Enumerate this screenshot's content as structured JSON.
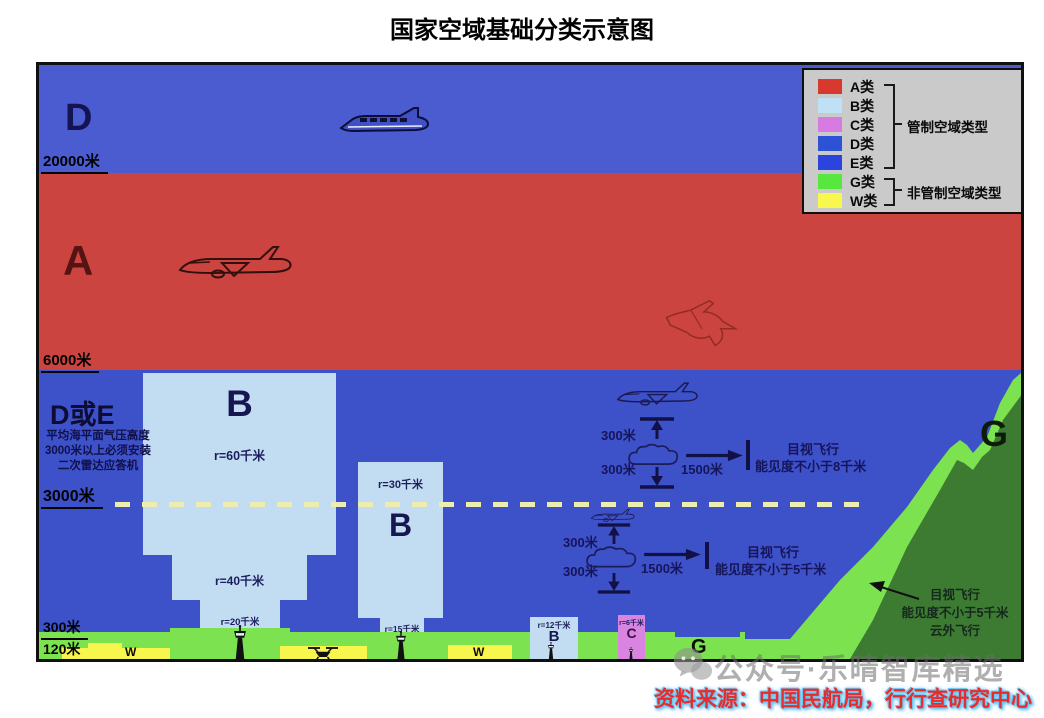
{
  "title": "国家空域基础分类示意图",
  "source": "资料来源：中国民航局，行行查研究中心",
  "watermark": "公众号·乐晴智库精选",
  "legend": {
    "items": [
      {
        "label": "A类",
        "color": "#d8392f"
      },
      {
        "label": "B类",
        "color": "#c0e0f6"
      },
      {
        "label": "C类",
        "color": "#d77ae2"
      },
      {
        "label": "D类",
        "color": "#2e52d6"
      },
      {
        "label": "E类",
        "color": "#2b44de"
      },
      {
        "label": "G类",
        "color": "#57e73f"
      },
      {
        "label": "W类",
        "color": "#f7f74e"
      }
    ],
    "groups": [
      {
        "label": "管制空域类型"
      },
      {
        "label": "非管制空域类型"
      }
    ]
  },
  "altitudes": {
    "a20000": "20000米",
    "a6000": "6000米",
    "a3000": "3000米",
    "a300": "300米",
    "a120": "120米"
  },
  "zones": {
    "d_upper": "D",
    "a": "A",
    "d_or_e": "D或E",
    "b_large": "B",
    "b_medium": "B",
    "b_small": "B",
    "c": "C",
    "g_mountain": "G",
    "g_ground": "G",
    "w_left": "W",
    "w_mid": "W"
  },
  "radius_labels": {
    "b_large_top": "r=60千米",
    "b_large_mid": "r=40千米",
    "b_large_base": "r=20千米",
    "b_medium_top": "r=30千米",
    "b_medium_base": "r=15千米",
    "b_small": "r=12千米",
    "c": "r=6千米"
  },
  "notes": {
    "transponder_line1": "平均海平面气压高度",
    "transponder_line2": "3000米以上必须安装",
    "transponder_line3": "二次雷达应答机"
  },
  "vfr_upper": {
    "gap_above": "300米",
    "gap_below": "300米",
    "visibility_dist": "1500米",
    "line1": "目视飞行",
    "line2": "能见度不小于8千米"
  },
  "vfr_lower": {
    "gap_above": "300米",
    "gap_below": "300米",
    "visibility_dist": "1500米",
    "line1": "目视飞行",
    "line2": "能见度不小于5千米"
  },
  "vfr_mountain": {
    "line1": "目视飞行",
    "line2": "能见度不小于5千米",
    "line3": "云外飞行"
  },
  "colors": {
    "zone_d_blue": "#4a5ccf",
    "zone_a_red": "#cc4440",
    "zone_lower_blue": "#3d51c9",
    "zone_b_lightblue": "#c2ddf1",
    "zone_c_violet": "#d884e0",
    "ground_green": "#7de24f",
    "mountain_green": "#3d7b33",
    "w_yellow": "#f6f64d",
    "legend_bg": "#cacaca",
    "source_red": "#e62c2c"
  }
}
